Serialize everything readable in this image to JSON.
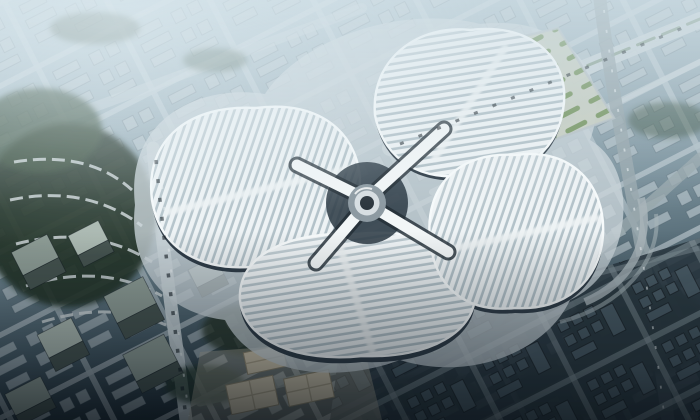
{
  "image": {
    "title": "Aerial rendering of a four-leaf-clover shaped exhibition center",
    "alt": "Bird's-eye architectural rendering: four white striped petal-shaped exhibition hall roofs joined at a central circular hub, surrounded by a diagonal city street grid, green parks, parking rows and low-rise blocks under hazy blue light that darkens toward the bottom of the frame",
    "width": 700,
    "height": 420
  },
  "scene": {
    "subject": "clover-exhibition-center",
    "elements": {
      "north_hall": "striped petal roof (upper)",
      "west_hall": "striped petal roof (left)",
      "south_hall": "striped petal roof (lower)",
      "east_hall": "striped petal roof (right)",
      "central_hub": "circular core with four white link bridges",
      "parking_lot": "tree-lined parking rows north-east of the halls",
      "park": "dense green park with curved housing rows on the left",
      "office_towers": "grey slab towers at lower left",
      "pavilions": "tan service buildings at bottom centre",
      "city_grid": "diagonal street grid of low-rise blocks",
      "atmosphere": "hazy blue-grey daylight, vignetted dark lower edge"
    },
    "colors": {
      "groundTop": "#b9ccd5",
      "groundMid": "#7b929d",
      "groundDark": "#1f2d36",
      "haze": "#d3e2e9",
      "roadLight": "#c9d4d8",
      "roadMid": "#98a7ad",
      "roadDark": "#72838a",
      "blockLight": "#bcc9cf",
      "blockDark": "#4a5c66",
      "treeDark": "#243528",
      "treeMid": "#3a4f3c",
      "treeLight": "#6d8f55",
      "parkingGround": "#c6ccc0",
      "roofRidge": "#eef3f5",
      "roofGap": "#b3c2c9",
      "rim": "#f6fafb",
      "facade": "#2f3c47",
      "podium": "#c9d3d8",
      "hubRing": "#8d9aa2",
      "hubCore": "#2c363e",
      "plazaTan": "#cdc3ab",
      "plazaTanDark": "#a89e85",
      "towerTop": "#8c9b94",
      "towerTopLight": "#aab8b0",
      "towerSide": "#45534f"
    }
  }
}
